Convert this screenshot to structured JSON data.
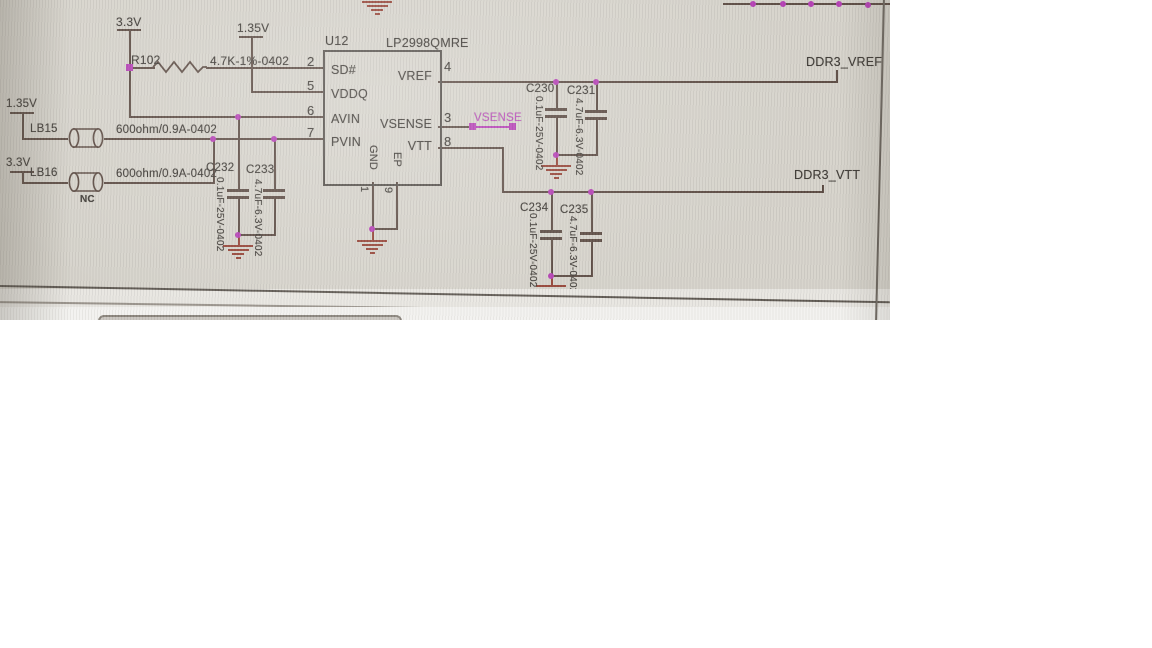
{
  "colors": {
    "photo_background": "#d6d3cb",
    "wire": "#5d4c44",
    "text": "#3f3b36",
    "junction_magenta": "#b540b5",
    "ground_red": "#964437",
    "chip_border": "#55504b"
  },
  "power_rails": {
    "rail_33v_top": "3.3V",
    "rail_135v_top": "1.35V",
    "rail_135v_left": "1.35V",
    "rail_33v_left": "3.3V"
  },
  "resistor": {
    "refdes": "R102",
    "value": "4.7K-1%-0402"
  },
  "beads": [
    {
      "refdes": "LB15",
      "value": "600ohm/0.9A-0402",
      "note": ""
    },
    {
      "refdes": "LB16",
      "value": "600ohm/0.9A-0402",
      "note": "NC"
    }
  ],
  "ic": {
    "refdes": "U12",
    "part_number": "LP2998QMRE",
    "left_pins": [
      {
        "num": "2",
        "name": "SD#"
      },
      {
        "num": "5",
        "name": "VDDQ"
      },
      {
        "num": "6",
        "name": "AVIN"
      },
      {
        "num": "7",
        "name": "PVIN"
      }
    ],
    "right_pins": [
      {
        "num": "4",
        "name": "VREF"
      },
      {
        "num": "3",
        "name": "VSENSE"
      },
      {
        "num": "8",
        "name": "VTT"
      }
    ],
    "bottom_pins": [
      {
        "num": "1",
        "name": "GND"
      },
      {
        "num": "9",
        "name": "EP"
      }
    ]
  },
  "capacitors": [
    {
      "refdes": "C232",
      "value": "0.1uF-25V-0402"
    },
    {
      "refdes": "C233",
      "value": "4.7uF-6.3V-0402"
    },
    {
      "refdes": "C230",
      "value": "0.1uF-25V-0402"
    },
    {
      "refdes": "C231",
      "value": "4.7uF-6.3V-0402"
    },
    {
      "refdes": "C234",
      "value": "0.1uF-25V-0402"
    },
    {
      "refdes": "C235",
      "value": "4.7uF-6.3V-0402"
    }
  ],
  "net_labels": {
    "ddr3_vref": "DDR3_VREF",
    "ddr3_vtt": "DDR3_VTT",
    "vsense": "VSENSE"
  }
}
